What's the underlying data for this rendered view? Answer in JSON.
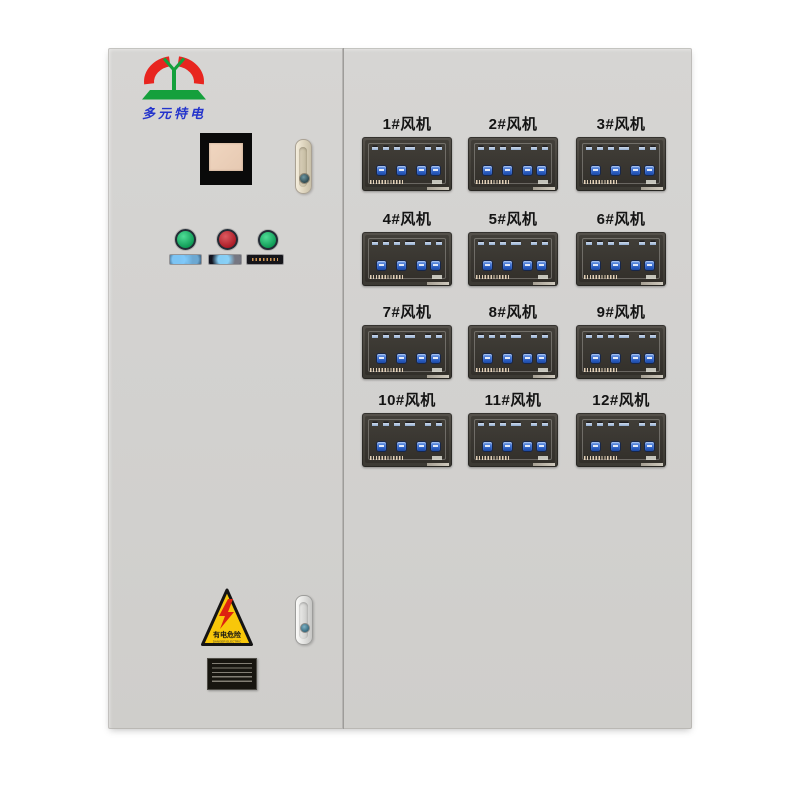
{
  "logo": {
    "text": "多元特电"
  },
  "left_door": {
    "push_buttons": [
      {
        "id": "green-1",
        "color": "#12a35c"
      },
      {
        "id": "red",
        "color": "#b62430"
      },
      {
        "id": "green-2",
        "color": "#12a35c"
      }
    ],
    "warning_sticker": {
      "title": "有电危险",
      "subtitle": "DANGER ELECTRIC"
    }
  },
  "fan_panels": {
    "labels": [
      "1#风机",
      "2#风机",
      "3#风机",
      "4#风机",
      "5#风机",
      "6#风机",
      "7#风机",
      "8#风机",
      "9#风机",
      "10#风机",
      "11#风机",
      "12#风机"
    ],
    "buttons_per_panel": 4
  },
  "colors": {
    "cabinet": "#d3d2d0",
    "panel_frame": "#4b4742",
    "panel_face": "#38352f",
    "panel_button_blue": "#2f6fd6",
    "logo_red": "#e8251f",
    "logo_green": "#15a03c",
    "logo_text_blue": "#2434cc",
    "warning_yellow": "#f8c70a",
    "indicator_green": "#12a35c",
    "indicator_red": "#b62430"
  }
}
